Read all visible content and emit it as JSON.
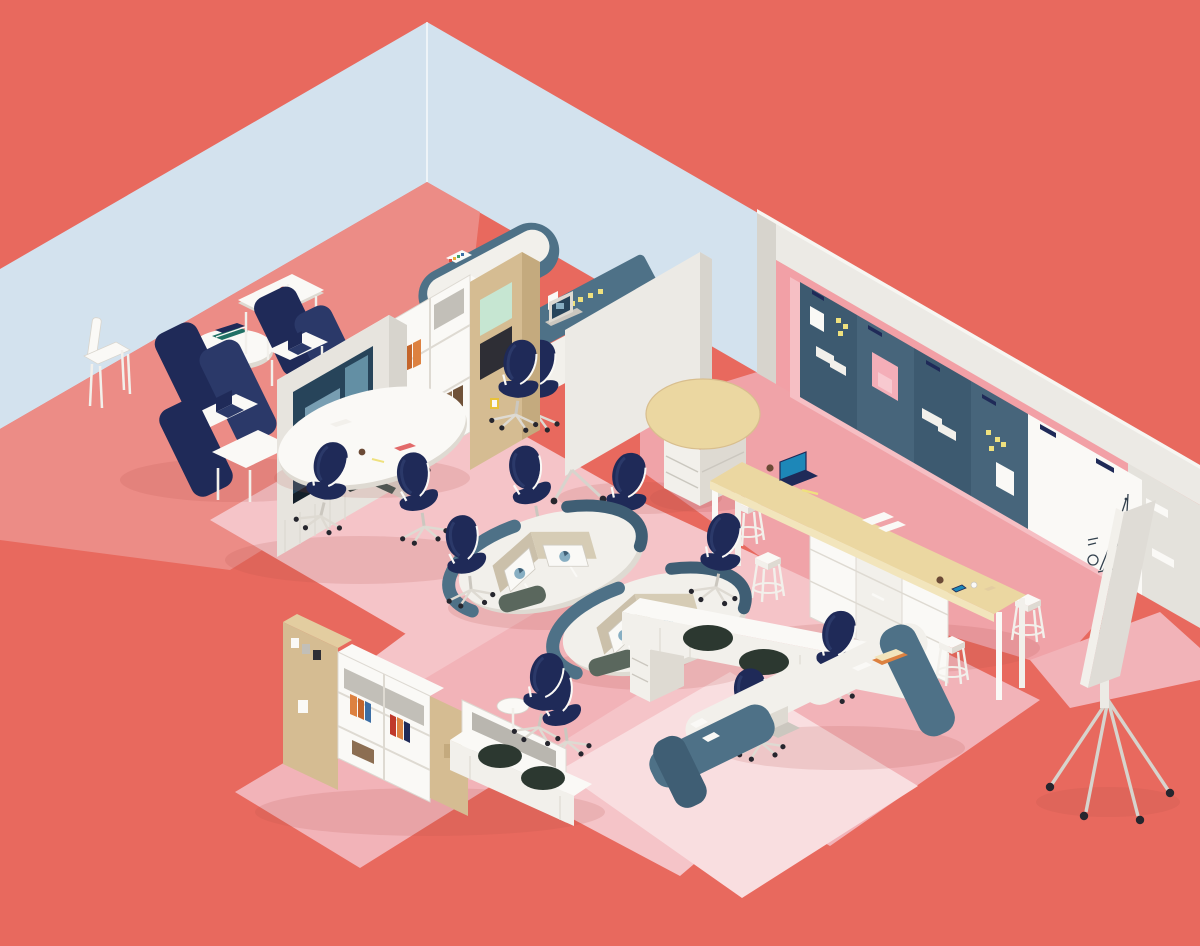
{
  "palette": {
    "coral": "#E8695E",
    "lightBlue": "#D3E2EE",
    "pinkPlatform": "#EC8C86",
    "pinkMat": "#F5C4C8",
    "pinkZone": "#F0A3A8",
    "pinkPale": "#F9DEE0",
    "pinkStrip": "#F2B3B8",
    "wallPink": "#F2A0A6",
    "wallPinkLight": "#F6BFC4",
    "trim": "#ECEAE5",
    "trimDark": "#D7D4CD",
    "grayWall": "#E4E2DC",
    "slate": "#4E7187",
    "slateDark": "#3F5E74",
    "boardNavy": "#3D5A70",
    "boardNavyAlt": "#47657B",
    "navy": "#1F2A58",
    "navyLight": "#2B3969",
    "white": "#FAF9F6",
    "offWhite": "#F2F0EB",
    "shade": "#DEDAD2",
    "shadeDark": "#CBC7BF",
    "grayBack": "#C2BFB8",
    "tan": "#D5BC92",
    "tanLight": "#E3CDA0",
    "wheat": "#EBD7A1",
    "counterEdge": "#F2E5BC",
    "mint": "#C6E6D2",
    "orange": "#DD8140",
    "orangeDark": "#C4652B",
    "yellow": "#EFE17E",
    "stickyPink": "#F4AEB8",
    "red": "#C0392B",
    "bookBlue": "#3C6EA5",
    "bookTeal": "#207065",
    "brown": "#8C6E52",
    "brownDark": "#6F5138",
    "greenCushion": "#2C3830",
    "padGreen": "#5A675D",
    "screenTeal": "#1D87B8",
    "screenDark": "#27445A",
    "paneBlue": "#87AEC2",
    "panelTan": "#CBC0AA",
    "panelTanLight": "#D6CCB5",
    "mugBrown": "#6B4A36",
    "ink": "#33414E",
    "wheel": "#26262E",
    "shadow": "#B5524C"
  },
  "scene": {
    "kind": "isometric-office-illustration",
    "areas": [
      "focus-booth-lounge",
      "media-conference-area",
      "panel-workstations",
      "central-workstation-pods",
      "standing-counter-cafe",
      "display-board-wall",
      "storage-shelf-wall",
      "collaboration-desks"
    ],
    "objects": [
      "navy-focus-booths",
      "cafe-side-chair",
      "round-pedestal-table",
      "square-cafe-table",
      "media-cabinet-with-tv",
      "bookshelf-hutch",
      "wooden-wardrobe",
      "conference-table",
      "navy-task-chairs",
      "mobile-divider-screen",
      "curved-panel-desks",
      "laptops",
      "dual-monitor-pods",
      "drawer-pedestal",
      "bench-with-round-cushions",
      "standing-shelf-round-top",
      "standing-counter",
      "bar-stools",
      "drawer-cabinets",
      "navy-pin-boards",
      "sticky-notes",
      "wall-whiteboards",
      "hand-drawn-chart",
      "wall-ledges",
      "mobile-whiteboard",
      "storage-shelving",
      "books",
      "coffee-mugs",
      "smartphone",
      "pencil",
      "papers"
    ]
  }
}
